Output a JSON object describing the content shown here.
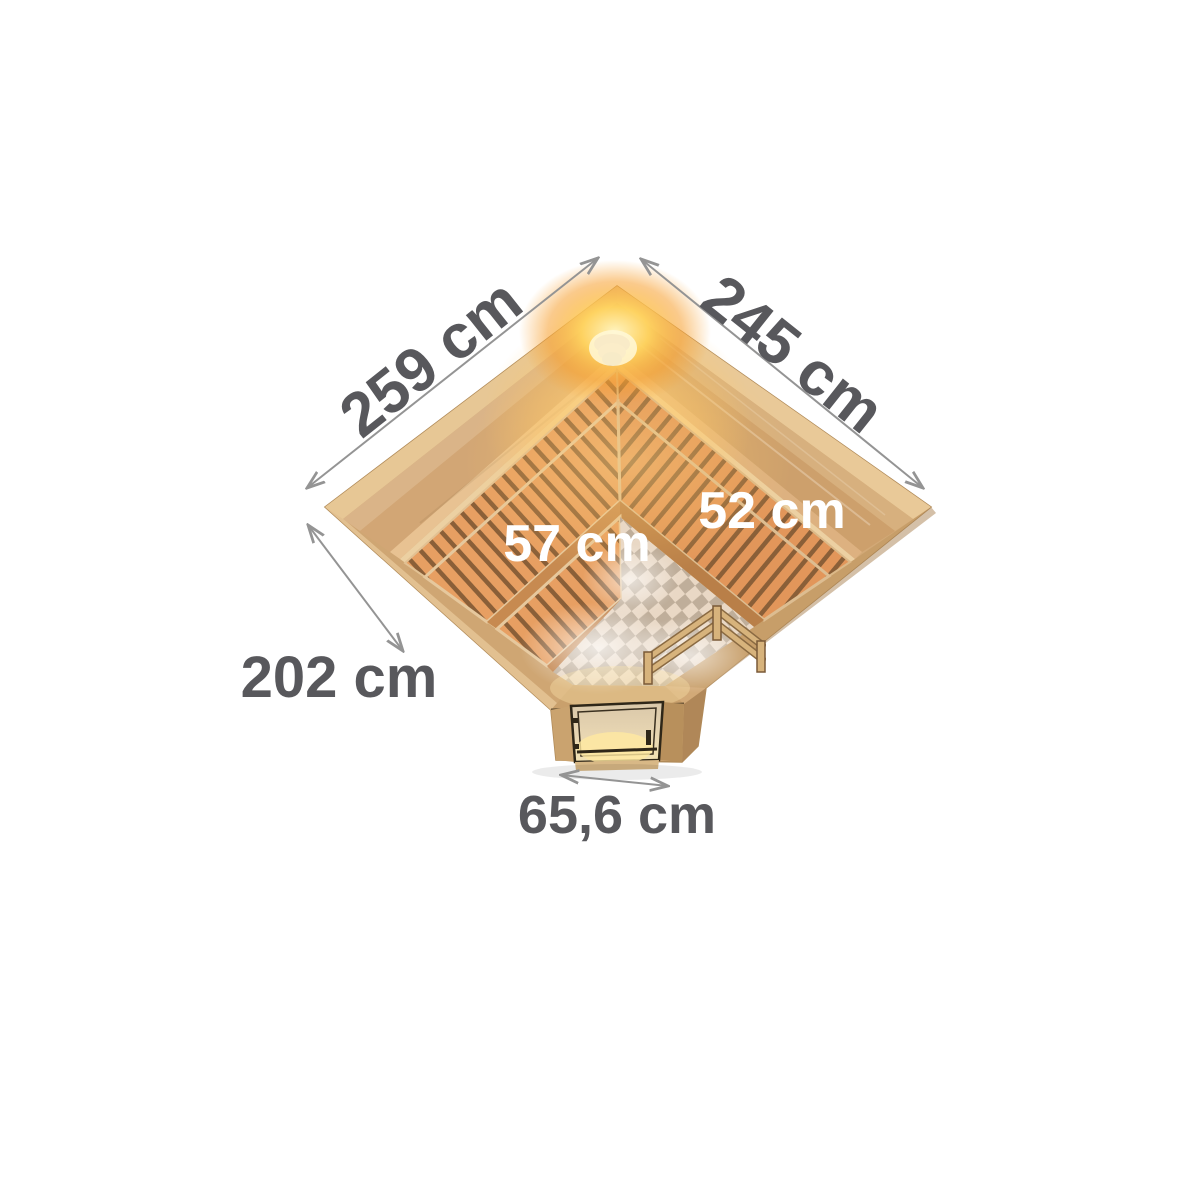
{
  "figure": {
    "description": "Top view dimension diagram of a corner-entry sauna with glass door, L-shaped slatted benches, heater guard rail, checkered floor and corner light",
    "dimensions": {
      "left_wall": "259 cm",
      "right_wall": "245 cm",
      "right_bench_depth": "52 cm",
      "left_bench_depth": "57 cm",
      "left_side": "202 cm",
      "door_width": "65,6 cm"
    },
    "colors": {
      "background": "#ffffff",
      "wood_trim_light": "#e9cf9f",
      "wood_band": "#d2a675",
      "wood_band_dark": "#c79e69",
      "interior_wall": "#ecd0a2",
      "bench_slat": "#e79f62",
      "bench_gap": "#8a5f38",
      "floor_check_light": "#e9d8c5",
      "floor_check_dark": "#bfae9a",
      "glow_core": "#fff4c0",
      "glow_warm": "#f79f2e",
      "door_glass": "#e8d6b2",
      "door_frame": "#2f2718",
      "dimension_text": "#58585c",
      "dimension_line": "#949494",
      "bench_text": "#ffffff"
    }
  }
}
